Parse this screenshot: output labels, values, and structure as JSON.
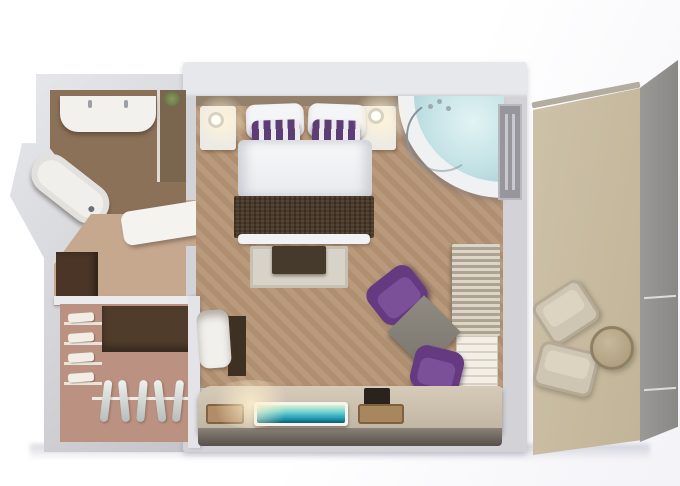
{
  "scene": {
    "type": "3d-floorplan-render",
    "description": "Top-down 3D rendering of a hotel suite floor plan; no text labels visible",
    "rooms": [
      {
        "name": "bathroom",
        "furniture": [
          "double-sink-vanity",
          "corner-bathtub",
          "shower-nook",
          "plant"
        ]
      },
      {
        "name": "entry-hall",
        "furniture": [
          "bench",
          "minibar-cabinet"
        ]
      },
      {
        "name": "walk-in-closet",
        "furniture": [
          "folded-linen-shelves",
          "clothes-rail-with-hangers",
          "wardrobe"
        ]
      },
      {
        "name": "bedroom",
        "furniture": [
          "double-bed-white-duvet",
          "white-pillows",
          "purple-striped-pillows",
          "nightstand-left",
          "nightstand-right",
          "wall-lamps",
          "woven-foot-bench",
          "rug",
          "dark-ottoman",
          "corner-whirlpool-tub",
          "balcony-door",
          "curtains",
          "towel-stack",
          "purple-armchair-1",
          "purple-armchair-2",
          "square-side-table",
          "tv-console",
          "flat-tv",
          "trays",
          "storage-box",
          "desk",
          "desk-chair",
          "media-mat"
        ]
      },
      {
        "name": "balcony",
        "furniture": [
          "lounge-chair-1",
          "lounge-chair-2",
          "round-table",
          "glass-railing"
        ]
      }
    ]
  },
  "palette": {
    "purple_chair": "#653a80",
    "pillow_purple": "#5d3e74",
    "pillow_stripe_white": "#edeaf0",
    "teal_tv": "#2aa3b1",
    "tub_water": "#c3e2e5",
    "bedroom_floor": "#b69575",
    "bathroom_floor": "#8c7159",
    "hall_floor": "#c6a88f",
    "closet_floor": "#bb9181",
    "balcony_floor": "#cdc1a8",
    "balcony_glass": "#9b9996",
    "wall_light": "#e7e8ec",
    "wall_mid": "#c4c4c9",
    "wood_dark": "#4a3929",
    "rug": "#d8d3c9",
    "console_top": "#d6cbb9",
    "curtain_light": "#ddd6c8",
    "curtain_dark": "#aca391",
    "lamp_glow": "#fff4d6",
    "white_linen": "#f4f5f7",
    "gray_table": "#8f8b83",
    "beige_furniture": "#cfc5b3"
  }
}
